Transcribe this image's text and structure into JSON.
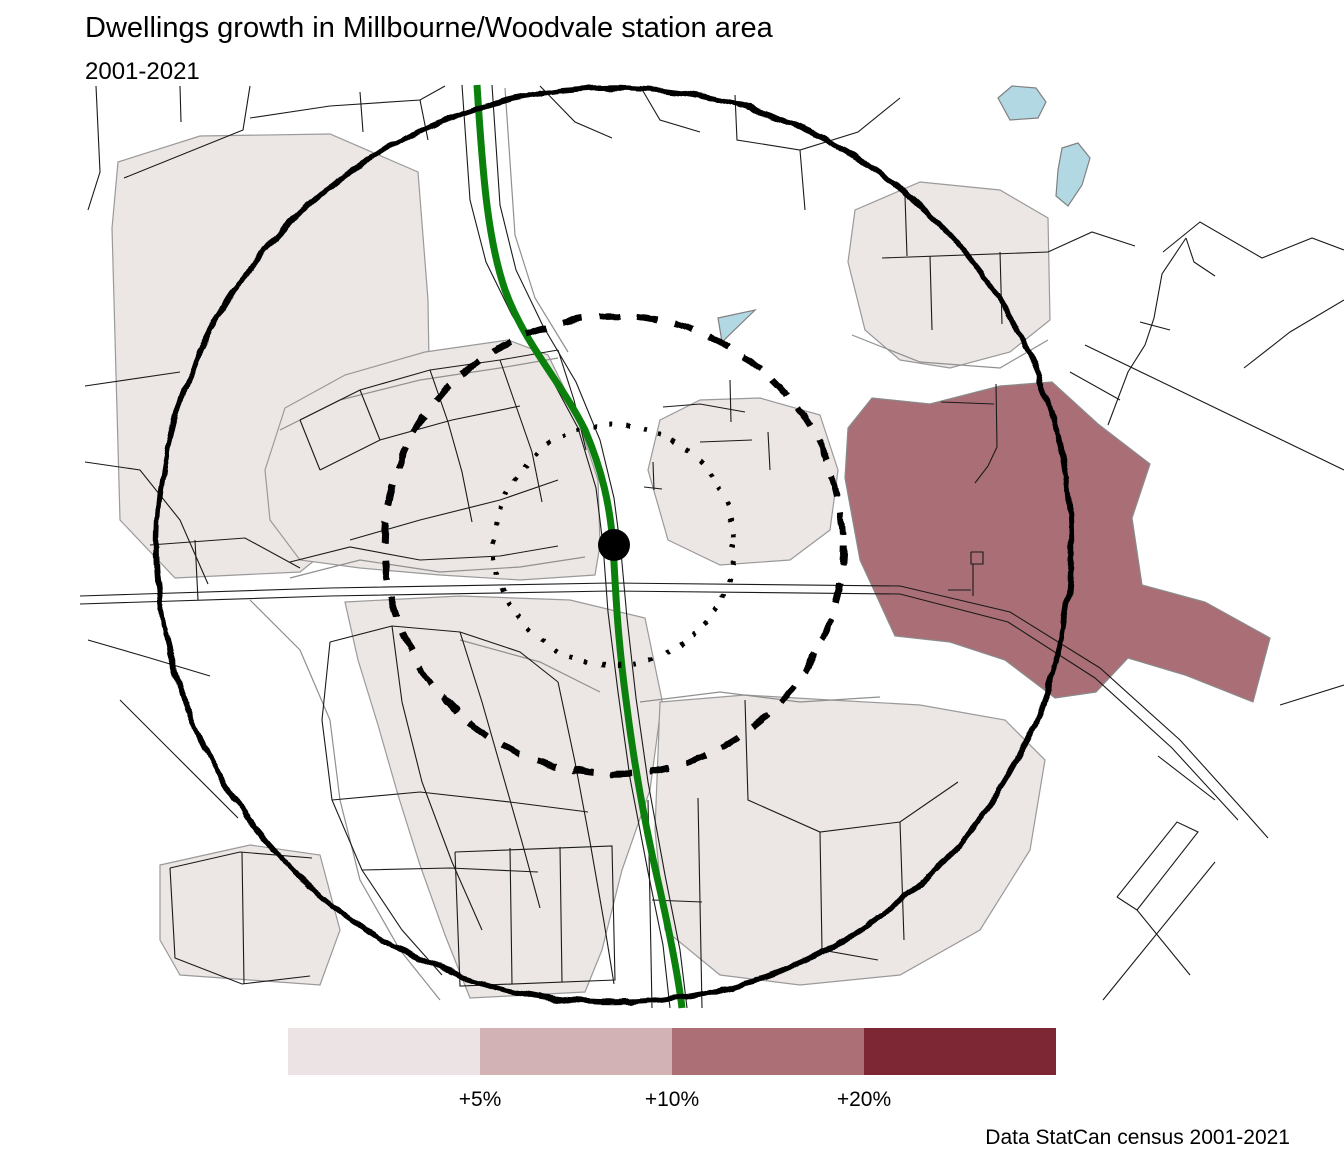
{
  "title": "Dwellings growth in Millbourne/Woodvale station area",
  "subtitle": "2001-2021",
  "caption": "Data StatCan census 2001-2021",
  "legend": {
    "labels": [
      "+5%",
      "+10%",
      "+20%"
    ],
    "colors": [
      "#ece4e4",
      "#d2b2b5",
      "#ab6f75",
      "#7c2733"
    ]
  },
  "map": {
    "colors": {
      "growth_low": "#ece6e4",
      "growth_mid": "#aa6f76",
      "water": "#b2d8e4",
      "transit_line": "#0c800c",
      "street": "#1a1a1a",
      "boundary": "#909090",
      "ring": "#000000"
    },
    "rings": [
      {
        "name": "inner-ring",
        "style": "dotted"
      },
      {
        "name": "middle-ring",
        "style": "dashed"
      },
      {
        "name": "outer-ring",
        "style": "solid"
      }
    ],
    "station": {
      "x": 614,
      "y": 545
    }
  }
}
